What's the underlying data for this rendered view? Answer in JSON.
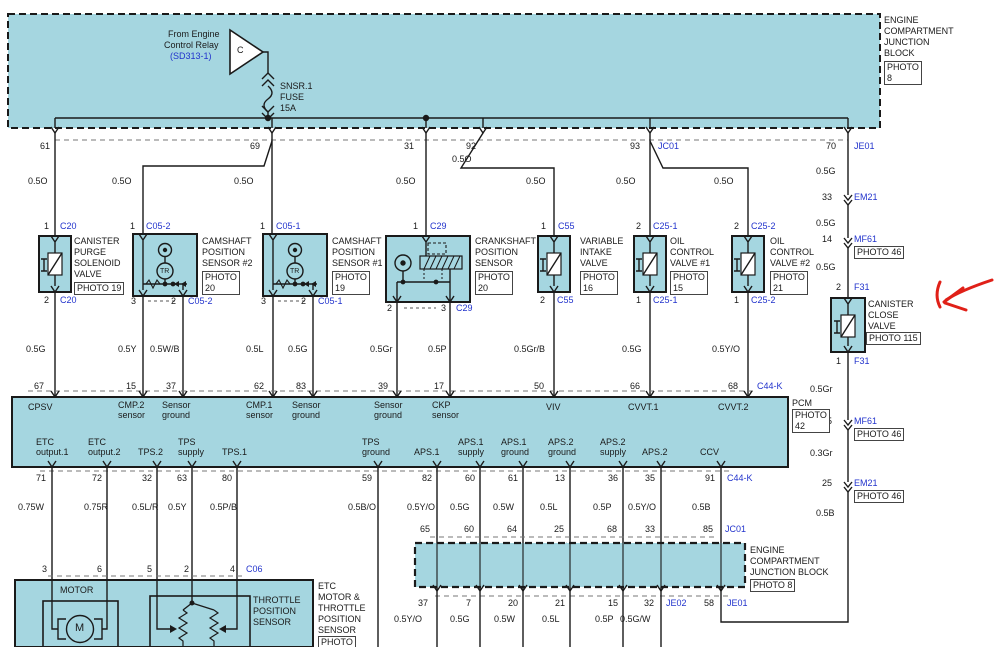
{
  "relay": {
    "l1": "From Engine",
    "l2": "Control Relay",
    "ref": "(SD313-1)",
    "letter": "C"
  },
  "fuse": {
    "name": "SNSR.1",
    "type": "FUSE",
    "rating": "15A"
  },
  "ecjb_top": {
    "l1": "ENGINE",
    "l2": "COMPARTMENT",
    "l3": "JUNCTION",
    "l4": "BLOCK",
    "photo_a": "PHOTO",
    "photo_b": "8"
  },
  "feeds": {
    "p61": "61",
    "p69": "69",
    "p31": "31",
    "p92": "92",
    "p93": "93",
    "jc01": "JC01",
    "p70": "70",
    "je01": "JE01",
    "w1": "0.5O",
    "w2": "0.5O",
    "w3": "0.5O",
    "w4": "0.5O",
    "w5": "0.5O",
    "w6": "0.5O",
    "w7": "0.5O",
    "w8": "0.5O"
  },
  "conn_top": {
    "c20p": "1",
    "c20": "C20",
    "c052p": "1",
    "c052": "C05-2",
    "c051p": "1",
    "c051": "C05-1",
    "c29p": "1",
    "c29": "C29",
    "c55p": "1",
    "c55": "C55",
    "c251p": "2",
    "c251": "C25-1",
    "c252p": "2",
    "c252": "C25-2"
  },
  "cpsv": {
    "n1": "CANISTER",
    "n2": "PURGE",
    "n3": "SOLENOID",
    "n4": "VALVE",
    "photo": "PHOTO 19",
    "bp": "2",
    "bc": "C20",
    "color": "0.5G"
  },
  "cmp2": {
    "n1": "CAMSHAFT",
    "n2": "POSITION",
    "n3": "SENSOR #2",
    "pha": "PHOTO",
    "phb": "20",
    "tr": "TR",
    "b1": "3",
    "b2": "2",
    "bc": "C05-2",
    "w1": "0.5Y",
    "w2": "0.5W/B"
  },
  "cmp1": {
    "n1": "CAMSHAFT",
    "n2": "POSITION",
    "n3": "SENSOR #1",
    "pha": "PHOTO",
    "phb": "19",
    "tr": "TR",
    "b1": "3",
    "b2": "2",
    "bc": "C05-1",
    "w1": "0.5L",
    "w2": "0.5G"
  },
  "ckp": {
    "n1": "CRANKSHAFT",
    "n2": "POSITION",
    "n3": "SENSOR",
    "pha": "PHOTO",
    "phb": "20",
    "b1": "2",
    "b2": "3",
    "bc": "C29",
    "w1": "0.5Gr",
    "w2": "0.5P"
  },
  "viv": {
    "n1": "VARIABLE",
    "n2": "INTAKE",
    "n3": "VALVE",
    "pha": "PHOTO",
    "phb": "16",
    "bp": "2",
    "bc": "C55",
    "color": "0.5Gr/B"
  },
  "ocv1": {
    "n1": "OIL",
    "n2": "CONTROL",
    "n3": "VALVE #1",
    "pha": "PHOTO",
    "phb": "15",
    "bp": "1",
    "bc": "C25-1",
    "color": "0.5G"
  },
  "ocv2": {
    "n1": "OIL",
    "n2": "CONTROL",
    "n3": "VALVE #2",
    "pha": "PHOTO",
    "phb": "21",
    "bp": "1",
    "bc": "C25-2",
    "color": "0.5Y/O"
  },
  "rcol": {
    "g1": "0.5G",
    "p33": "33",
    "em21": "EM21",
    "g2": "0.5G",
    "p14": "14",
    "mf61": "MF61",
    "ph46a": "PHOTO 46",
    "g3": "0.5G",
    "p2": "2",
    "f31a": "F31",
    "ccv1": "CANISTER",
    "ccv2": "CLOSE",
    "ccv3": "VALVE",
    "ccvph": "PHOTO 115",
    "p1": "1",
    "f31b": "F31",
    "gr": "0.5Gr",
    "p15": "15",
    "mf61b": "MF61",
    "ph46b": "PHOTO 46",
    "gr03": "0.3Gr",
    "p25": "25",
    "em21b": "EM21",
    "ph46c": "PHOTO 46",
    "b": "0.5B"
  },
  "pcm": {
    "name": "PCM",
    "pha": "PHOTO",
    "phb": "42",
    "tpins": {
      "p67": "67",
      "p15": "15",
      "p37": "37",
      "p62": "62",
      "p83": "83",
      "p39": "39",
      "p17": "17",
      "p50": "50",
      "p66": "66",
      "p68": "68",
      "c44k": "C44-K"
    },
    "tlabels": {
      "cpsv": "CPSV",
      "cmp2a": "CMP.2",
      "cmp2b": "sensor",
      "sg1a": "Sensor",
      "sg1b": "ground",
      "cmp1a": "CMP.1",
      "cmp1b": "sensor",
      "sg2a": "Sensor",
      "sg2b": "ground",
      "sg3a": "Sensor",
      "sg3b": "ground",
      "ckpa": "CKP",
      "ckpb": "sensor",
      "viv": "VIV",
      "cvvt1": "CVVT.1",
      "cvvt2": "CVVT.2"
    },
    "blabels": {
      "etc1a": "ETC",
      "etc1b": "output.1",
      "etc2a": "ETC",
      "etc2b": "output.2",
      "tps2": "TPS.2",
      "tpssa": "TPS",
      "tpssb": "supply",
      "tps1": "TPS.1",
      "tpsga": "TPS",
      "tpsgb": "ground",
      "aps1": "APS.1",
      "aps1sa": "APS.1",
      "aps1sb": "supply",
      "aps1ga": "APS.1",
      "aps1gb": "ground",
      "aps2ga": "APS.2",
      "aps2gb": "ground",
      "aps2sa": "APS.2",
      "aps2sb": "supply",
      "aps2": "APS.2",
      "ccv": "CCV"
    },
    "bpins": {
      "p71": "71",
      "p72": "72",
      "p32": "32",
      "p63": "63",
      "p80": "80",
      "p59": "59",
      "p82": "82",
      "p60": "60",
      "p61": "61",
      "p13": "13",
      "p36": "36",
      "p35": "35",
      "p91": "91",
      "c44k": "C44-K"
    },
    "bcolors": {
      "c1": "0.75W",
      "c2": "0.75R",
      "c3": "0.5L/R",
      "c4": "0.5Y",
      "c5": "0.5P/B",
      "c6": "0.5B/O",
      "c7": "0.5Y/O",
      "c8": "0.5G",
      "c9": "0.5W",
      "c10": "0.5L",
      "c11": "0.5P",
      "c12": "0.5Y/O",
      "c13": "0.5B"
    }
  },
  "jb": {
    "i65": "65",
    "i60": "60",
    "i64": "64",
    "i25": "25",
    "i68": "68",
    "i33": "33",
    "i85": "85",
    "jc01": "JC01",
    "l1": "ENGINE",
    "l2": "COMPARTMENT",
    "l3": "JUNCTION BLOCK",
    "photo": "PHOTO 8",
    "o37": "37",
    "o7": "7",
    "o20": "20",
    "o21": "21",
    "o15": "15",
    "o32": "32",
    "je02": "JE02",
    "o58": "58",
    "je01": "JE01",
    "w1": "0.5Y/O",
    "w2": "0.5G",
    "w3": "0.5W",
    "w4": "0.5L",
    "w5": "0.5P",
    "w6": "0.5G/W"
  },
  "etcm": {
    "p3": "3",
    "p6": "6",
    "p5": "5",
    "p2": "2",
    "p4": "4",
    "c06": "C06",
    "motor": "MOTOR",
    "m": "M",
    "t1": "THROTTLE",
    "t2": "POSITION",
    "t3": "SENSOR",
    "e1": "ETC",
    "e2": "MOTOR &",
    "e3": "THROTTLE",
    "e4": "POSITION",
    "e5": "SENSOR",
    "photo": "PHOTO"
  }
}
